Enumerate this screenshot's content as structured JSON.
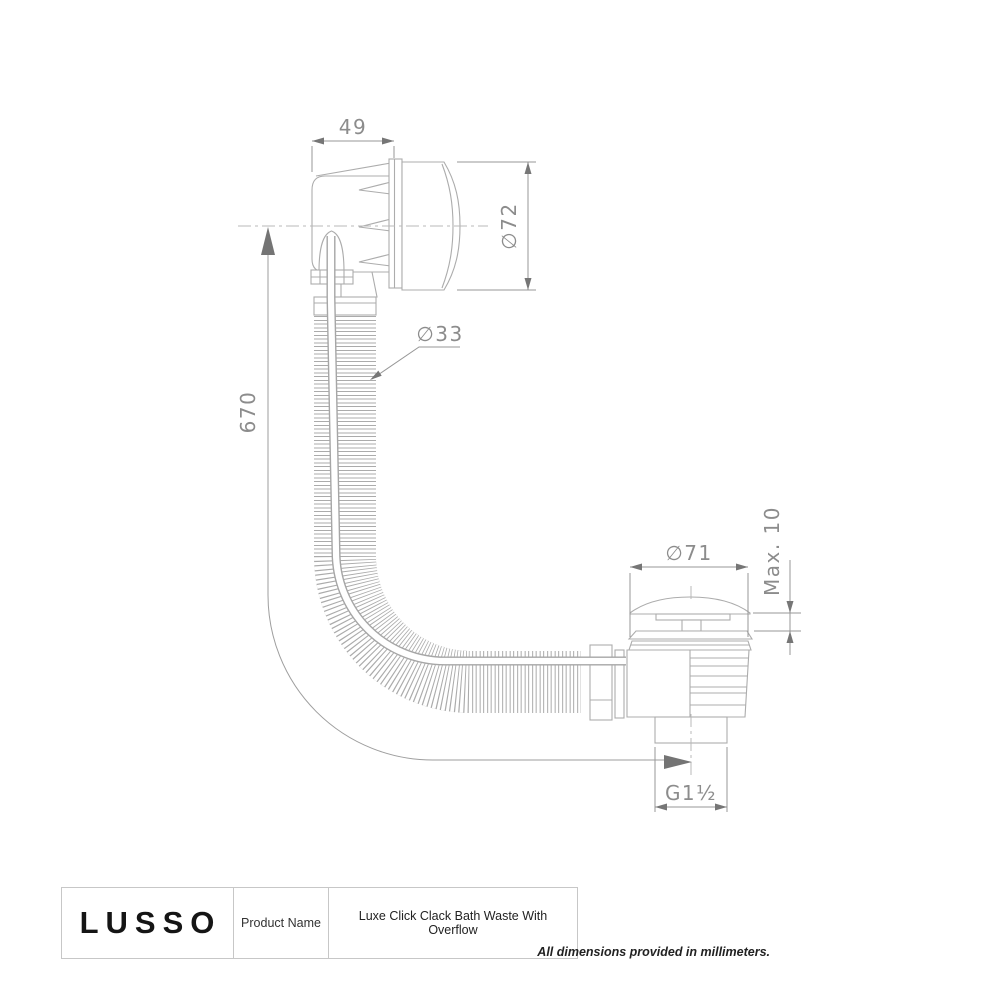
{
  "drawing": {
    "colors": {
      "part_line": "#acacac",
      "dimension_line": "#979797",
      "arrow": "#767676",
      "centerline": "#b8b8b8",
      "text": "#8c8c8c"
    },
    "dimensions": {
      "overflow_width": "49",
      "overflow_diameter": "∅72",
      "hose_diameter": "∅33",
      "hose_length": "670",
      "waste_diameter": "∅71",
      "max_deck_thickness": "Max. 10",
      "thread_size": "G1½"
    }
  },
  "title_block": {
    "brand": "LUSSO",
    "field_label": "Product Name",
    "product_name": "Luxe Click Clack Bath Waste With Overflow"
  },
  "footnote": "All dimensions provided in millimeters."
}
